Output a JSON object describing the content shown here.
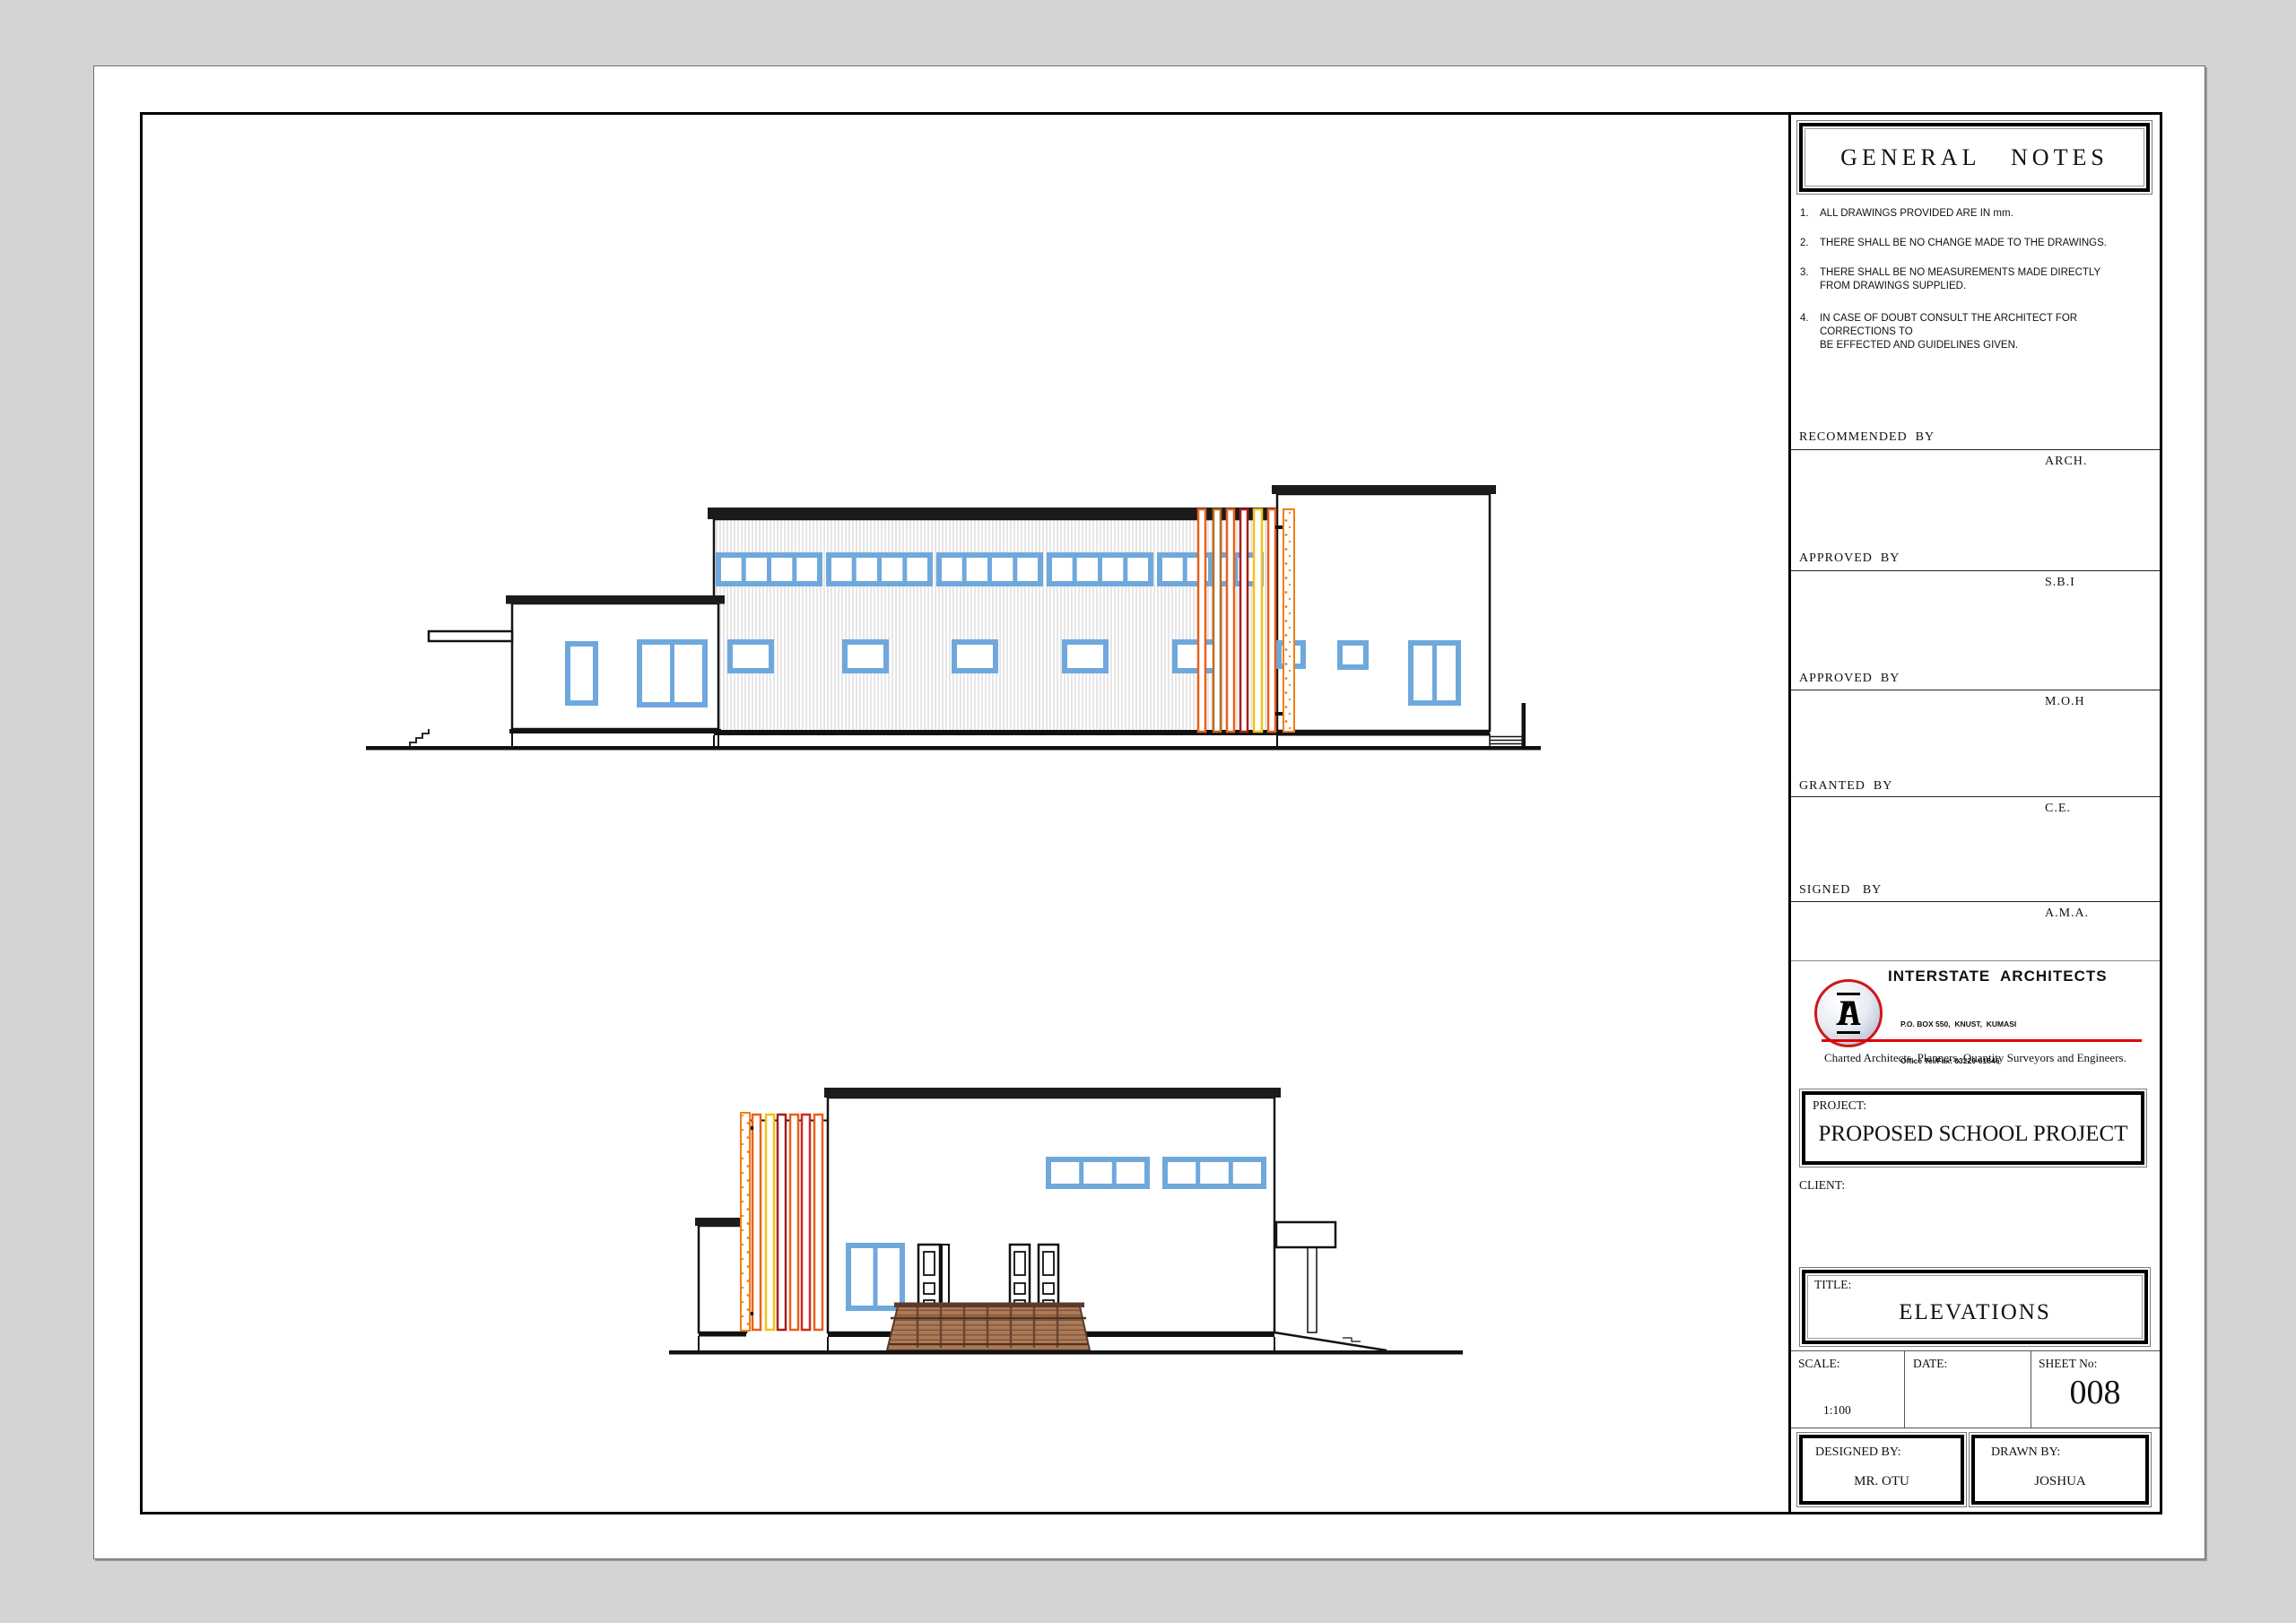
{
  "title_block": {
    "general_notes": {
      "title": "GENERAL   NOTES",
      "items": [
        {
          "num": "1.",
          "text": "ALL DRAWINGS PROVIDED ARE IN mm."
        },
        {
          "num": "2.",
          "text": "THERE SHALL BE NO CHANGE MADE TO THE DRAWINGS."
        },
        {
          "num": "3.",
          "text": "THERE SHALL BE NO MEASUREMENTS MADE DIRECTLY\nFROM DRAWINGS SUPPLIED."
        },
        {
          "num": "4.",
          "text": "IN CASE OF DOUBT CONSULT THE ARCHITECT FOR CORRECTIONS TO\nBE EFFECTED AND GUIDELINES GIVEN."
        }
      ]
    },
    "signatures": [
      {
        "label": "RECOMMENDED  BY",
        "designation": "ARCH."
      },
      {
        "label": "APPROVED  BY",
        "designation": "S.B.I"
      },
      {
        "label": "APPROVED  BY",
        "designation": "M.O.H"
      },
      {
        "label": "GRANTED  BY",
        "designation": "C.E."
      },
      {
        "label": "SIGNED   BY",
        "designation": "A.M.A."
      }
    ],
    "firm": {
      "name": "INTERSTATE  ARCHITECTS",
      "logo_monogram": "IA",
      "address_lines": [
        "P.O. BOX 550,  KNUST,  KUMASI",
        "Office Tel/Fax: 03220-61846",
        "Residence: 03220-36324/024-231414",
        "Location: 21 ADOMAA CRESCENT,BOMSO-KSI"
      ],
      "tagline": "Charted Architects, Planners, Quantity Surveyors and Engineers."
    },
    "project": {
      "label": "PROJECT:",
      "value": "PROPOSED SCHOOL PROJECT"
    },
    "client": {
      "label": "CLIENT:",
      "value": ""
    },
    "sheet_title": {
      "label": "TITLE:",
      "value": "ELEVATIONS"
    },
    "scale": {
      "label": "SCALE:",
      "value": "1:100"
    },
    "date": {
      "label": "DATE:",
      "value": ""
    },
    "sheet_no": {
      "label": "SHEET No:",
      "value": "008"
    },
    "designed_by": {
      "label": "DESIGNED BY:",
      "value": "MR. OTU"
    },
    "drawn_by": {
      "label": "DRAWN BY:",
      "value": "JOSHUA"
    }
  },
  "drawings": {
    "top_elevation": "side-elevation with clerestory windows, colored louver fins and end stairs",
    "bottom_elevation": "front-elevation with entrance doors, timber deck ramp and colored louver fins"
  },
  "palette": {
    "page_bg": "#d4d4d6",
    "window_blue": "#6fa8dc",
    "fin_orange": "#e8611c",
    "fin_amber": "#bf6a1f",
    "fin_red": "#d02c1c",
    "fin_dark_red": "#a81c1c",
    "fin_yellow": "#f3c218",
    "speck_orange": "#f07f17",
    "deck_brown": "#ab7a57",
    "deck_dark": "#5b3a29",
    "accent_red": "#e10000",
    "hatch_gray": "#c9c9c9"
  }
}
